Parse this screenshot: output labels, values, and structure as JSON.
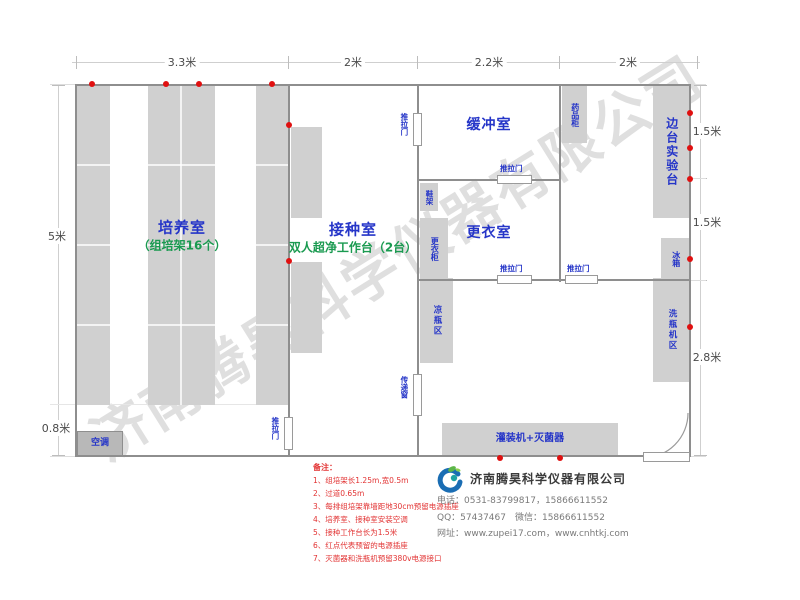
{
  "watermark": "济南腾昊科学仪器有限公司",
  "dims": {
    "top": [
      "3.3米",
      "2米",
      "2.2米",
      "2米"
    ],
    "left": [
      "5米",
      "0.8米"
    ],
    "right": [
      "1.5米",
      "1.5米",
      "2.8米"
    ]
  },
  "rooms": {
    "culture": {
      "name": "培养室",
      "sub": "（组培架16个）"
    },
    "inoculation": {
      "name": "接种室",
      "sub": "双人超净工作台（2台）"
    },
    "buffer": {
      "name": "缓冲室"
    },
    "changing": {
      "name": "更衣室"
    }
  },
  "fixtures": {
    "side_bench": "边台实验台",
    "medicine_cabinet": "药品柜",
    "fridge": "冰箱",
    "shoe_rack": "鞋架",
    "wardrobe": "更衣柜",
    "cool_bottle_area": "凉瓶区",
    "washer_area": "洗瓶机区",
    "filler_sterilizer": "灌装机+灭菌器",
    "air_conditioner": "空调",
    "pass_window": "传递窗",
    "sliding_door": "推拉门"
  },
  "notes": {
    "title": "备注：",
    "items": [
      "1、组培架长1.25m,宽0.5m",
      "2、过道0.65m",
      "3、每排组培架靠墙距地30cm预留电源插座",
      "4、培养室、接种室安装空调",
      "5、接种工作台长为1.5米",
      "6、红点代表预留的电源插座",
      "7、灭菌器和洗瓶机预留380v电源接口"
    ]
  },
  "company": {
    "name": "济南腾昊科学仪器有限公司",
    "phone": "电话：0531-83799817，15866611552",
    "qq_wechat": "QQ：57437467　微信：15866611552",
    "website": "网址：www.zupei17.com，www.cnhtkj.com"
  },
  "colors": {
    "room_label": "#2535c8",
    "sub_label": "#1a9a50",
    "note_red": "#e23333",
    "wall_gray": "#8e8e8e",
    "fixture_gray": "#d0d0d0",
    "socket_red": "#e01010"
  }
}
